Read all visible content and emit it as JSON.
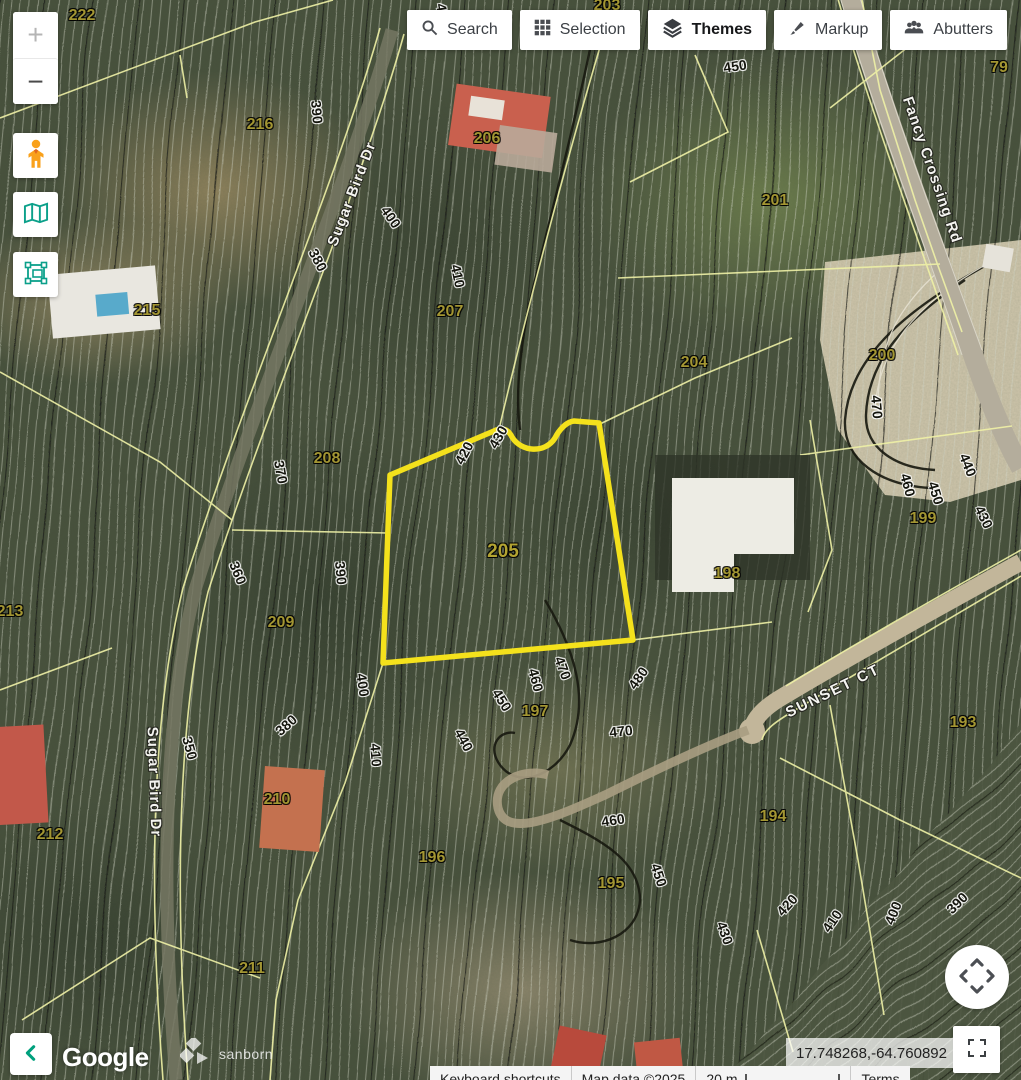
{
  "toolbar": {
    "buttons": [
      {
        "label": "Search",
        "icon": "search-icon",
        "active": false
      },
      {
        "label": "Selection",
        "icon": "grid-icon",
        "active": false
      },
      {
        "label": "Themes",
        "icon": "layers-icon",
        "active": true
      },
      {
        "label": "Markup",
        "icon": "brush-icon",
        "active": false
      },
      {
        "label": "Abutters",
        "icon": "people-icon",
        "active": false
      }
    ]
  },
  "map_controls": {
    "zoom_in_label": "+",
    "zoom_out_label": "−",
    "pegman_icon": "street-view-pegman",
    "basemap_icon": "folded-map",
    "areaselect_icon": "area-select",
    "collapse_icon": "chevron-left",
    "pan_icon": "pan-arrows",
    "fullscreen_icon": "fullscreen-corners"
  },
  "coordinates_display": "17.748268,-64.760892",
  "footer": {
    "google": "Google",
    "sanborn": "sanborn",
    "keyboard_shortcuts": "Keyboard shortcuts",
    "map_data": "Map data ©2025",
    "scale": "20 m",
    "terms": "Terms"
  },
  "map": {
    "selected_parcel_label": {
      "t": "205",
      "x": 503,
      "y": 552
    },
    "parcel_labels": [
      {
        "t": "222",
        "x": 82,
        "y": 16
      },
      {
        "t": "203",
        "x": 607,
        "y": 6
      },
      {
        "t": "216",
        "x": 260,
        "y": 125
      },
      {
        "t": "206",
        "x": 487,
        "y": 139
      },
      {
        "t": "79",
        "x": 999,
        "y": 68
      },
      {
        "t": "201",
        "x": 775,
        "y": 201
      },
      {
        "t": "215",
        "x": 147,
        "y": 311
      },
      {
        "t": "207",
        "x": 450,
        "y": 312
      },
      {
        "t": "204",
        "x": 694,
        "y": 363
      },
      {
        "t": "200",
        "x": 882,
        "y": 356
      },
      {
        "t": "208",
        "x": 327,
        "y": 459
      },
      {
        "t": "198",
        "x": 727,
        "y": 574
      },
      {
        "t": "199",
        "x": 923,
        "y": 519
      },
      {
        "t": "213",
        "x": 10,
        "y": 612
      },
      {
        "t": "209",
        "x": 281,
        "y": 623
      },
      {
        "t": "197",
        "x": 535,
        "y": 712
      },
      {
        "t": "193",
        "x": 963,
        "y": 723
      },
      {
        "t": "194",
        "x": 773,
        "y": 817
      },
      {
        "t": "210",
        "x": 277,
        "y": 800
      },
      {
        "t": "212",
        "x": 50,
        "y": 835
      },
      {
        "t": "196",
        "x": 432,
        "y": 858
      },
      {
        "t": "195",
        "x": 611,
        "y": 884
      },
      {
        "t": "211",
        "x": 252,
        "y": 969
      }
    ],
    "contour_labels": [
      {
        "t": "430",
        "x": 443,
        "y": 15,
        "r": 80
      },
      {
        "t": "450",
        "x": 735,
        "y": 66,
        "r": -8
      },
      {
        "t": "390",
        "x": 317,
        "y": 112,
        "r": 85
      },
      {
        "t": "400",
        "x": 391,
        "y": 217,
        "r": 55
      },
      {
        "t": "380",
        "x": 318,
        "y": 260,
        "r": 62
      },
      {
        "t": "410",
        "x": 458,
        "y": 276,
        "r": 78
      },
      {
        "t": "370",
        "x": 281,
        "y": 472,
        "r": 80
      },
      {
        "t": "390",
        "x": 341,
        "y": 573,
        "r": 85
      },
      {
        "t": "360",
        "x": 238,
        "y": 573,
        "r": 68
      },
      {
        "t": "420",
        "x": 464,
        "y": 453,
        "r": -62
      },
      {
        "t": "430",
        "x": 498,
        "y": 437,
        "r": -60
      },
      {
        "t": "350",
        "x": 190,
        "y": 748,
        "r": 75
      },
      {
        "t": "380",
        "x": 286,
        "y": 725,
        "r": -42
      },
      {
        "t": "400",
        "x": 363,
        "y": 685,
        "r": 82
      },
      {
        "t": "410",
        "x": 376,
        "y": 755,
        "r": 86
      },
      {
        "t": "440",
        "x": 464,
        "y": 740,
        "r": 62
      },
      {
        "t": "450",
        "x": 502,
        "y": 700,
        "r": 58
      },
      {
        "t": "460",
        "x": 536,
        "y": 680,
        "r": 75
      },
      {
        "t": "470",
        "x": 563,
        "y": 668,
        "r": 70
      },
      {
        "t": "480",
        "x": 638,
        "y": 678,
        "r": -55
      },
      {
        "t": "470",
        "x": 621,
        "y": 731,
        "r": -6
      },
      {
        "t": "460",
        "x": 613,
        "y": 820,
        "r": -8
      },
      {
        "t": "450",
        "x": 659,
        "y": 875,
        "r": 72
      },
      {
        "t": "470",
        "x": 877,
        "y": 407,
        "r": 85
      },
      {
        "t": "460",
        "x": 908,
        "y": 485,
        "r": 75
      },
      {
        "t": "450",
        "x": 936,
        "y": 493,
        "r": 73
      },
      {
        "t": "440",
        "x": 968,
        "y": 465,
        "r": 68
      },
      {
        "t": "430",
        "x": 984,
        "y": 517,
        "r": 64
      },
      {
        "t": "430",
        "x": 725,
        "y": 933,
        "r": 70
      },
      {
        "t": "420",
        "x": 787,
        "y": 905,
        "r": -48
      },
      {
        "t": "410",
        "x": 832,
        "y": 921,
        "r": -55
      },
      {
        "t": "400",
        "x": 893,
        "y": 913,
        "r": -68
      },
      {
        "t": "390",
        "x": 957,
        "y": 903,
        "r": -45
      }
    ],
    "street_labels": [
      {
        "t": "Sugar Bird Dr",
        "x": 352,
        "y": 194,
        "r": -69
      },
      {
        "t": "Sugar Bird Dr",
        "x": 154,
        "y": 782,
        "r": 88
      },
      {
        "t": "Fancy Crossing Rd",
        "x": 932,
        "y": 170,
        "r": 71
      },
      {
        "t": "SUNSET CT",
        "x": 833,
        "y": 691,
        "r": -26,
        "ls": 2
      }
    ]
  },
  "colors": {
    "accent_teal": "#00a07d",
    "selection_yellow": "#f4e11c",
    "pegman_orange": "#f9a11b",
    "parcel_line_yellow": "#eff1a6",
    "button_text": "#3c4045"
  }
}
